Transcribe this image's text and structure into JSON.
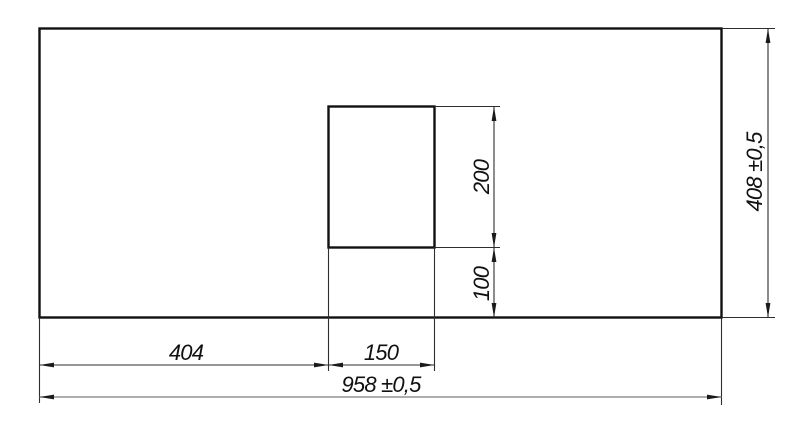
{
  "drawing": {
    "kind": "technical-dimension-drawing",
    "background_color": "#ffffff",
    "outline_color": "#111111",
    "dimension_line_color": "#2e2e2e",
    "dimensions": {
      "left_offset": "404",
      "cutout_width": "150",
      "overall_width": "958 ±0,5",
      "cutout_height": "200",
      "cutout_bottom_offset": "100",
      "overall_height": "408 ±0,5"
    }
  }
}
